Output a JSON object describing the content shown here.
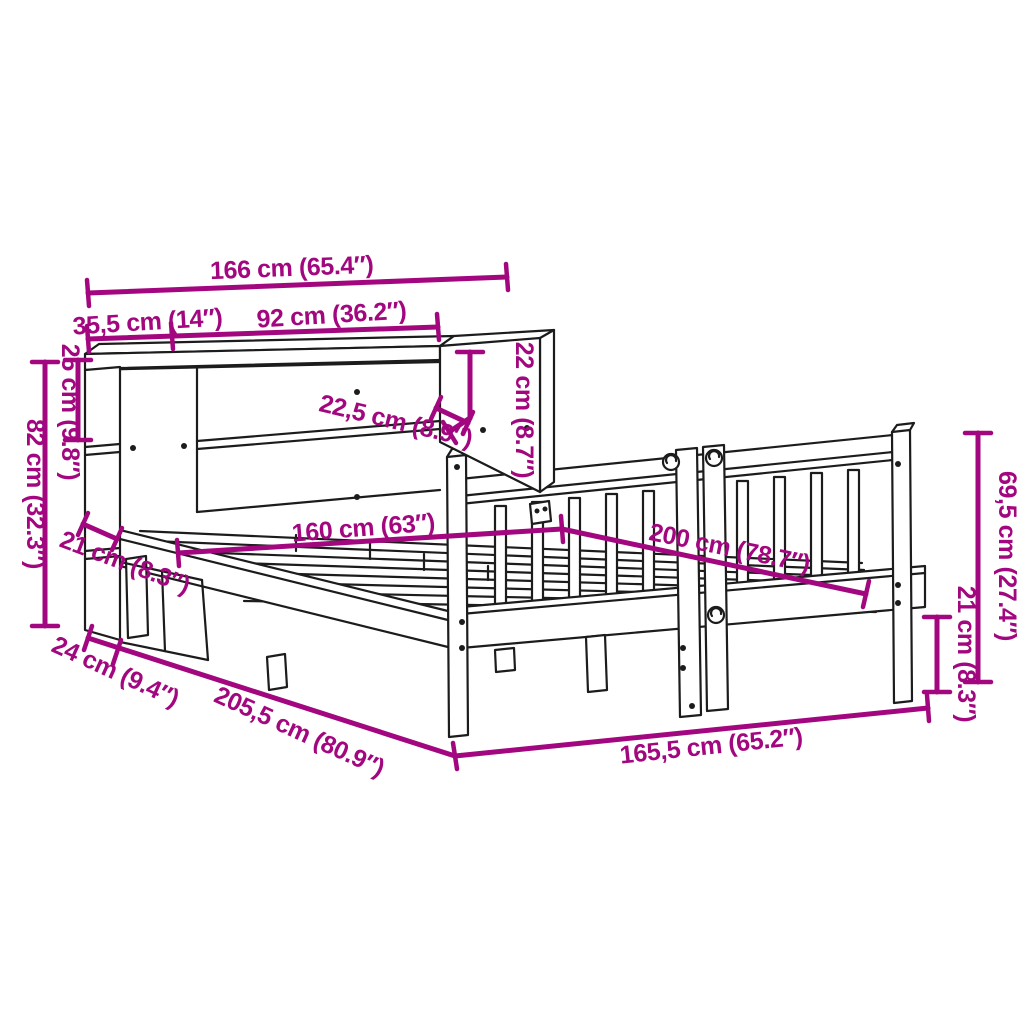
{
  "diagram": {
    "title": "bed-frame-with-bookcase-dimension-diagram",
    "background_color": "#ffffff",
    "accent_color": "#a2077f",
    "line_color": "#1c1c1c",
    "dimensions": [
      {
        "id": "total-width",
        "label": "166 cm (65.4″)"
      },
      {
        "id": "left-shelf-width",
        "label": "35,5 cm (14″)"
      },
      {
        "id": "main-shelf-width",
        "label": "92 cm (36.2″)"
      },
      {
        "id": "top-cabinet-height",
        "label": "22 cm (8.7″)"
      },
      {
        "id": "top-shelf-height",
        "label": "25 cm (9.8″)"
      },
      {
        "id": "bookcase-height",
        "label": "82 cm (32.3″)"
      },
      {
        "id": "shelf-depth",
        "label": "22,5 cm (8.9″)"
      },
      {
        "id": "bed-width",
        "label": "160 cm (63″)"
      },
      {
        "id": "bed-length",
        "label": "200 cm (78.7″)"
      },
      {
        "id": "gap-height",
        "label": "21 cm (8.3″)"
      },
      {
        "id": "bookcase-depth",
        "label": "24 cm (9.4″)"
      },
      {
        "id": "frame-length",
        "label": "205,5 cm (80.9″)"
      },
      {
        "id": "frame-width",
        "label": "165,5 cm (65.2″)"
      },
      {
        "id": "headboard-height",
        "label": "69,5 cm (27.4″)"
      },
      {
        "id": "leg-height",
        "label": "21 cm (8.3″)"
      }
    ]
  }
}
